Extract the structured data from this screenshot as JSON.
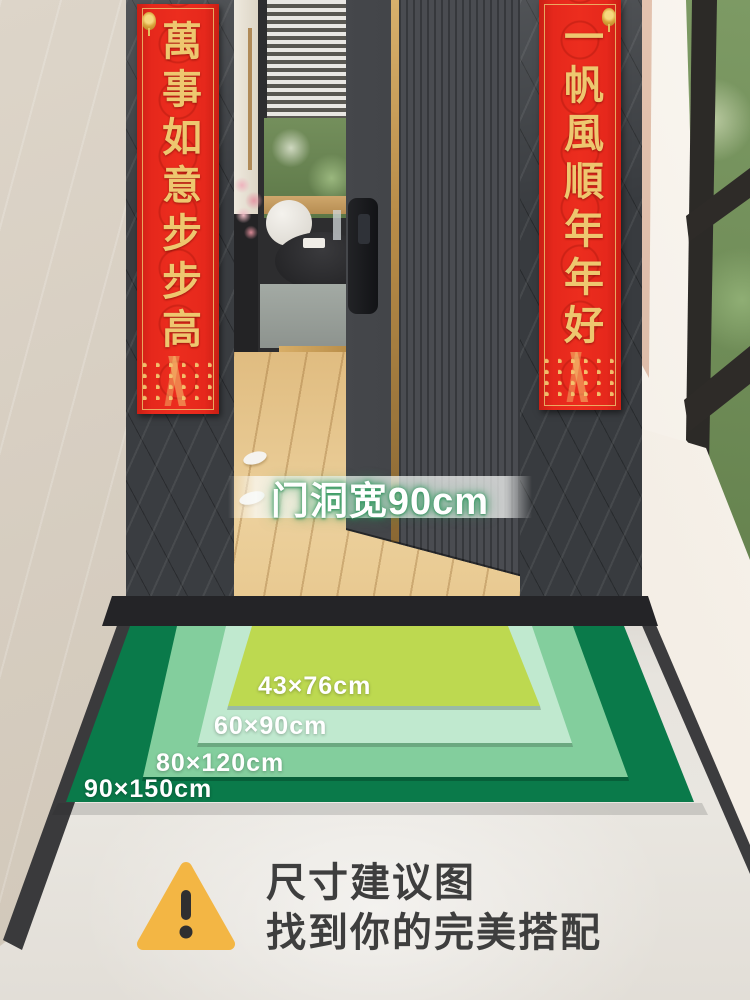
{
  "couplets": {
    "left": {
      "text": "萬事如意步步高"
    },
    "right": {
      "text": "一帆風順年年好"
    }
  },
  "door_label": {
    "text": "门洞宽90cm",
    "door_width_cm": 90
  },
  "size_chart": {
    "type": "nested-size-diagram",
    "mats": [
      {
        "label": "90×150cm",
        "width_cm": 90,
        "length_cm": 150,
        "color": "#0a7a4a"
      },
      {
        "label": "80×120cm",
        "width_cm": 80,
        "length_cm": 120,
        "color": "#83ce9d"
      },
      {
        "label": "60×90cm",
        "width_cm": 60,
        "length_cm": 90,
        "color": "#c0e9cf"
      },
      {
        "label": "43×76cm",
        "width_cm": 43,
        "length_cm": 76,
        "color": "#bdd950"
      }
    ]
  },
  "footer": {
    "line1": "尺寸建议图",
    "line2": "找到你的完美搭配"
  },
  "colors": {
    "couplet_red": "#e6281c",
    "couplet_gold": "#eec76f",
    "mat_label_text": "#ffffff",
    "warning_triangle": "#f3b644",
    "footer_text": "#3e3e3e",
    "door_label_glow": "#2e8b57"
  }
}
